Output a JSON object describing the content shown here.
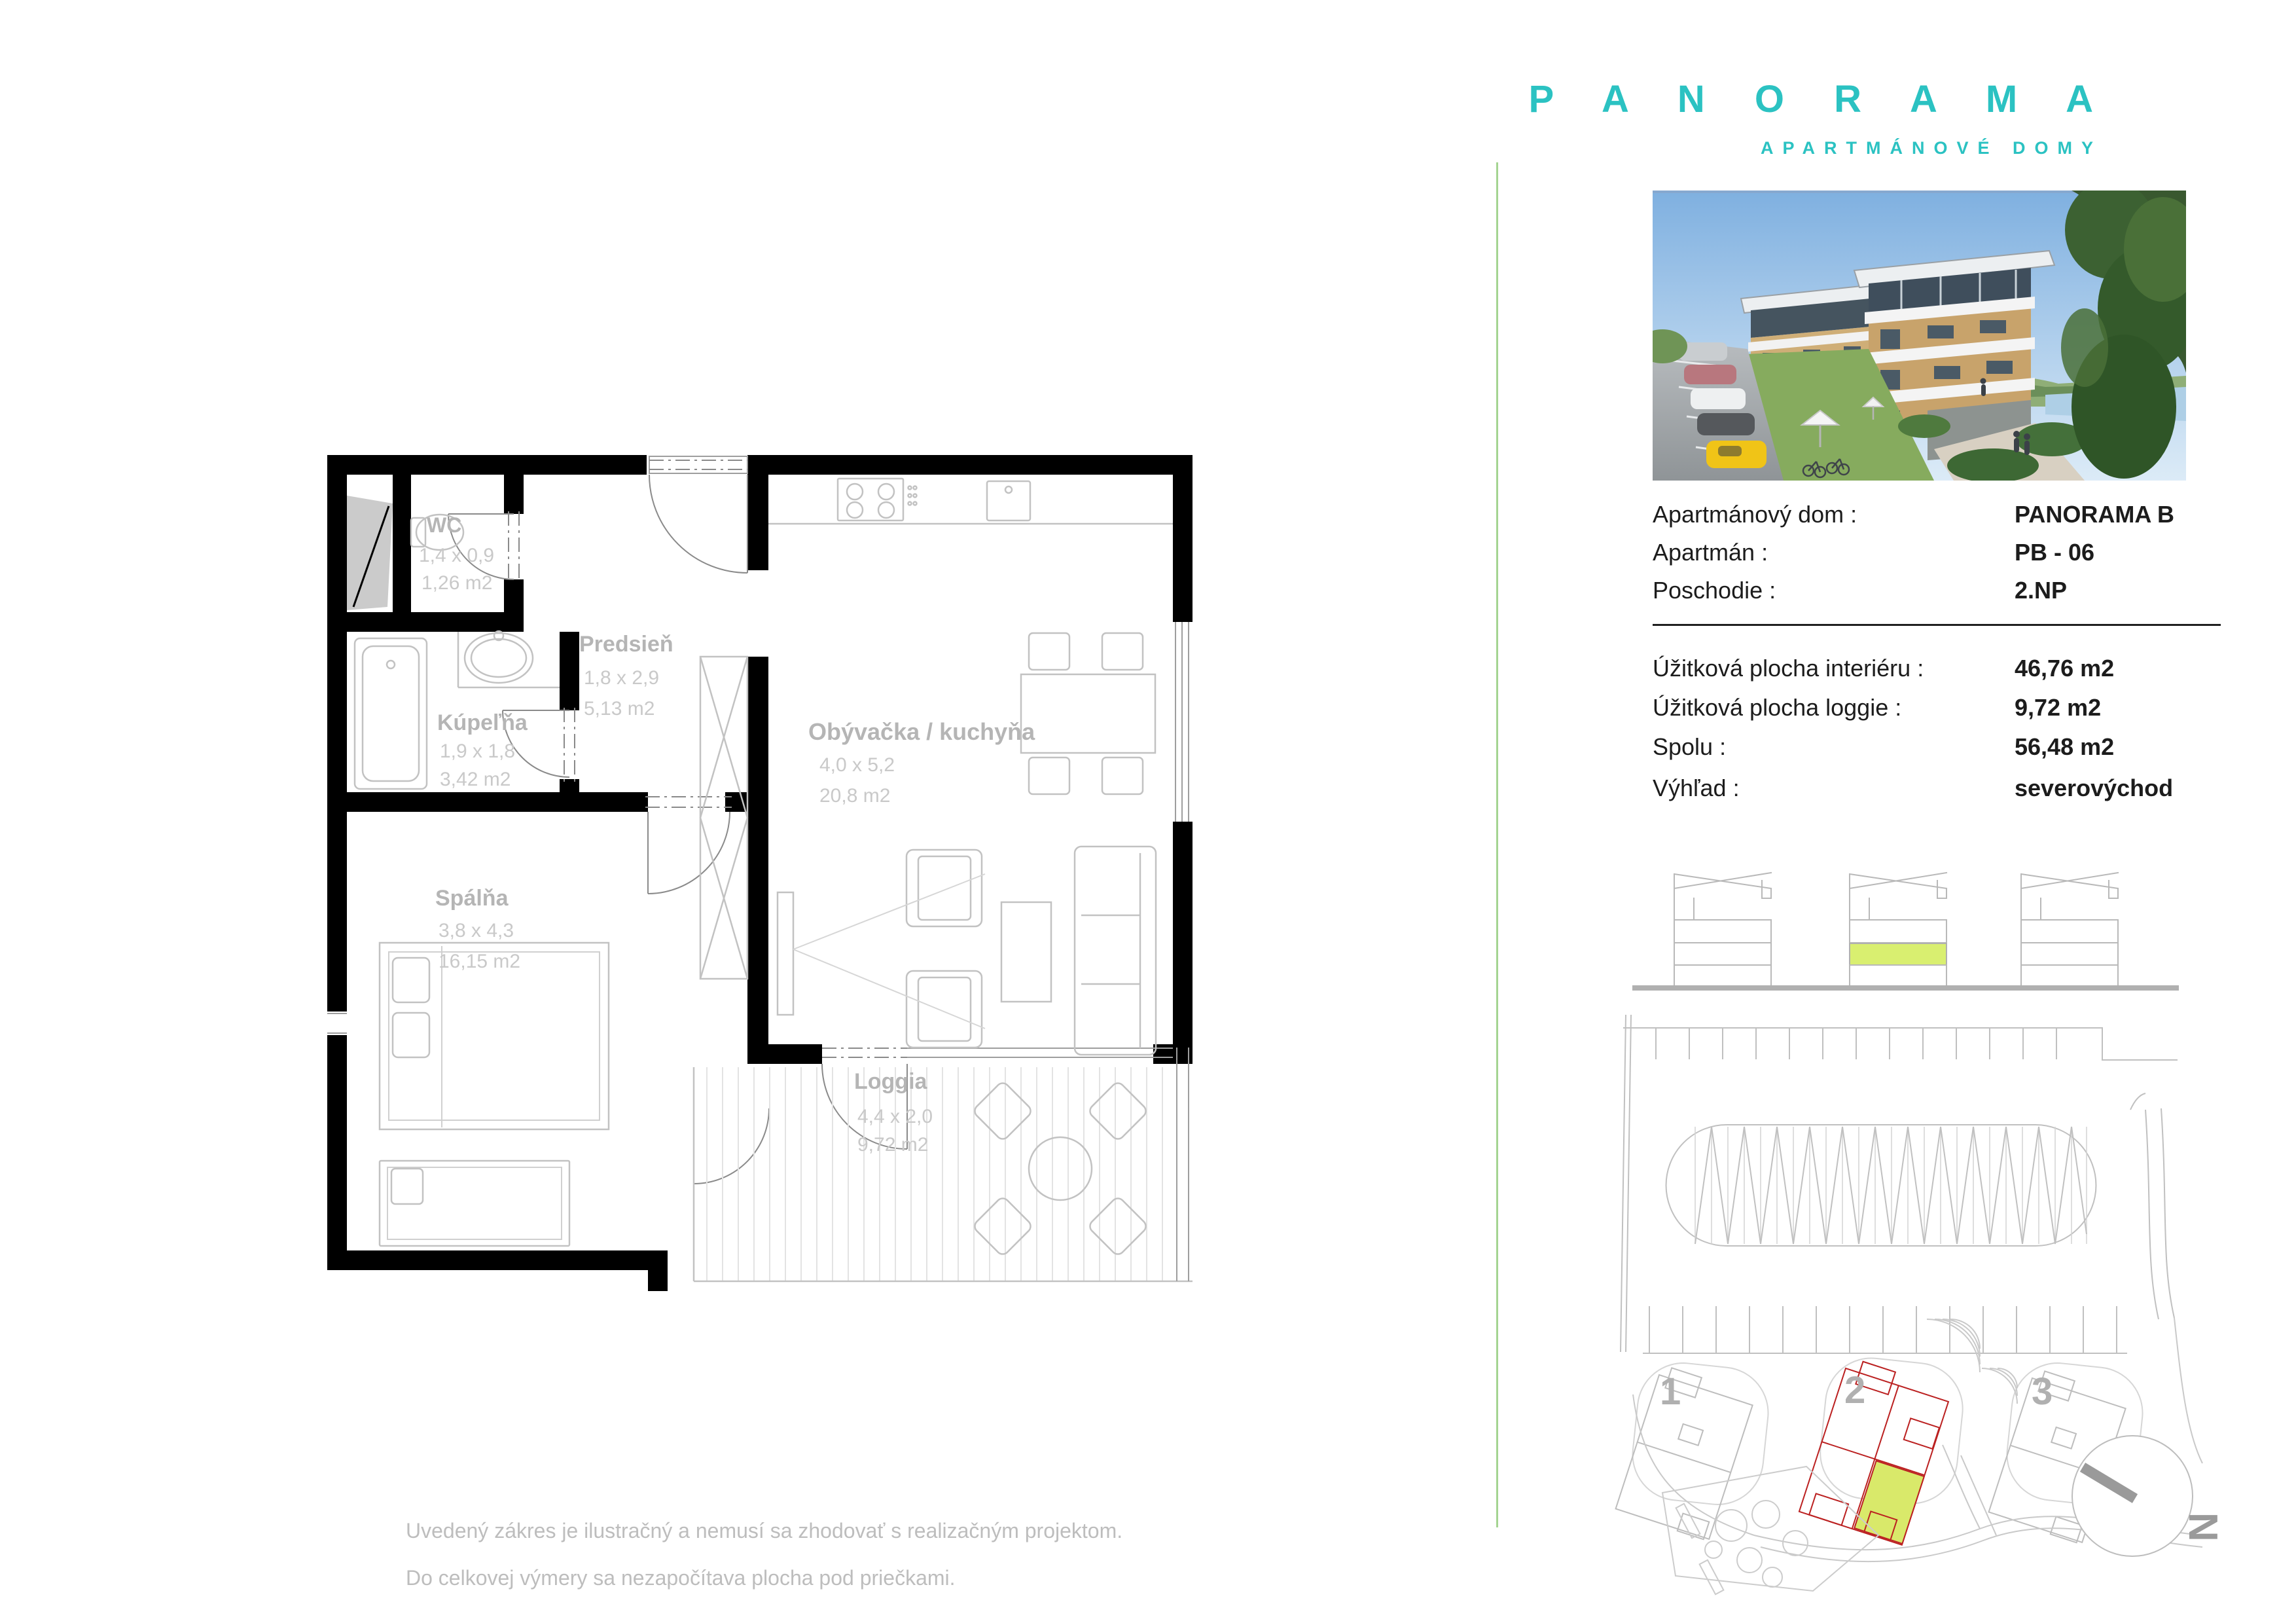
{
  "logo": {
    "title": "P A N O R A M A",
    "subtitle": "APARTMÁNOVÉ DOMY",
    "color": "#2bc2c2"
  },
  "details": {
    "rows": [
      {
        "label": "Apartmánový dom :",
        "value": "PANORAMA B"
      },
      {
        "label": "Apartmán :",
        "value": "PB - 06"
      },
      {
        "label": "Poschodie :",
        "value": "2.NP"
      }
    ]
  },
  "areas": {
    "rows": [
      {
        "label": "Úžitková plocha interiéru :",
        "value": "46,76 m2"
      },
      {
        "label": "Úžitková plocha loggie :",
        "value": "9,72 m2"
      },
      {
        "label": "Spolu :",
        "value": "56,48 m2"
      },
      {
        "label": "Výhľad :",
        "value": "severovýchod"
      }
    ]
  },
  "floorplan": {
    "rooms": {
      "wc": {
        "name": "WC",
        "dims": "1,4 x 0,9",
        "area": "1,26 m2"
      },
      "hall": {
        "name": "Predsieň",
        "dims": "1,8 x 2,9",
        "area": "5,13 m2"
      },
      "bath": {
        "name": "Kúpeľňa",
        "dims": "1,9 x 1,8",
        "area": "3,42 m2"
      },
      "living": {
        "name": "Obývačka / kuchyňa",
        "dims": "4,0 x 5,2",
        "area": "20,8 m2"
      },
      "bedroom": {
        "name": "Spálňa",
        "dims": "3,8 x 4,3",
        "area": "16,15 m2"
      },
      "loggia": {
        "name": "Loggia",
        "dims": "4,4 x 2,0",
        "area": "9,72 m2"
      }
    }
  },
  "elevation": {
    "highlight_color": "#d9ef70"
  },
  "siteplan": {
    "building_numbers": [
      "1",
      "2",
      "3"
    ],
    "north_label": "N",
    "outline_color": "#bb2020",
    "highlight_color": "#d9e96a"
  },
  "disclaimer": {
    "line1": "Uvedený zákres je ilustračný a nemusí sa zhodovať s realizačným projektom.",
    "line2": "Do celkovej výmery sa nezapočítava plocha pod priečkami."
  }
}
